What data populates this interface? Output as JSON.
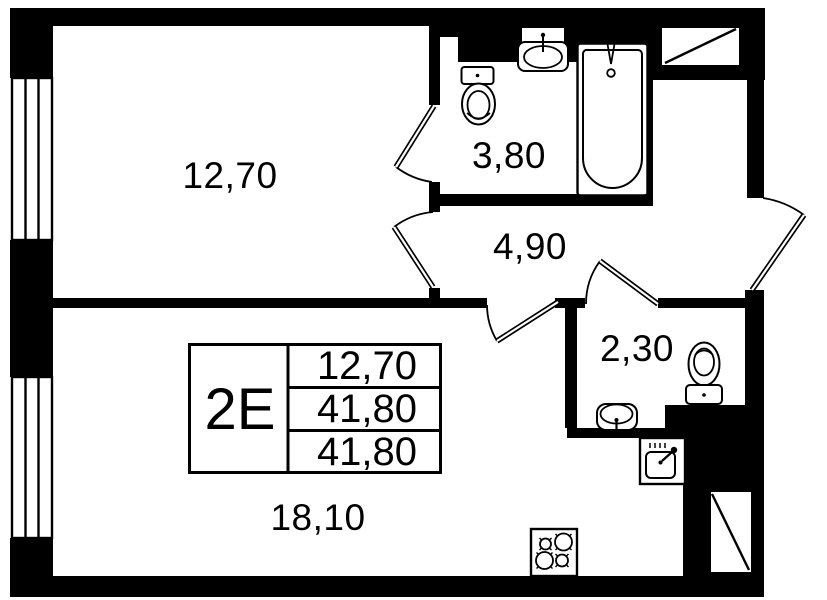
{
  "floor_plan": {
    "unit_type_label": "2Е",
    "rooms": {
      "bedroom": {
        "area": "12,70"
      },
      "bathroom": {
        "area": "3,80"
      },
      "hallway": {
        "area": "4,90"
      },
      "wc": {
        "area": "2,30"
      },
      "living_kitchen": {
        "area": "18,10"
      }
    },
    "info_table": {
      "type": "2Е",
      "row1": "12,70",
      "row2": "41,80",
      "row3": "41,80"
    },
    "colors": {
      "wall": "#000000",
      "background": "#ffffff"
    }
  }
}
